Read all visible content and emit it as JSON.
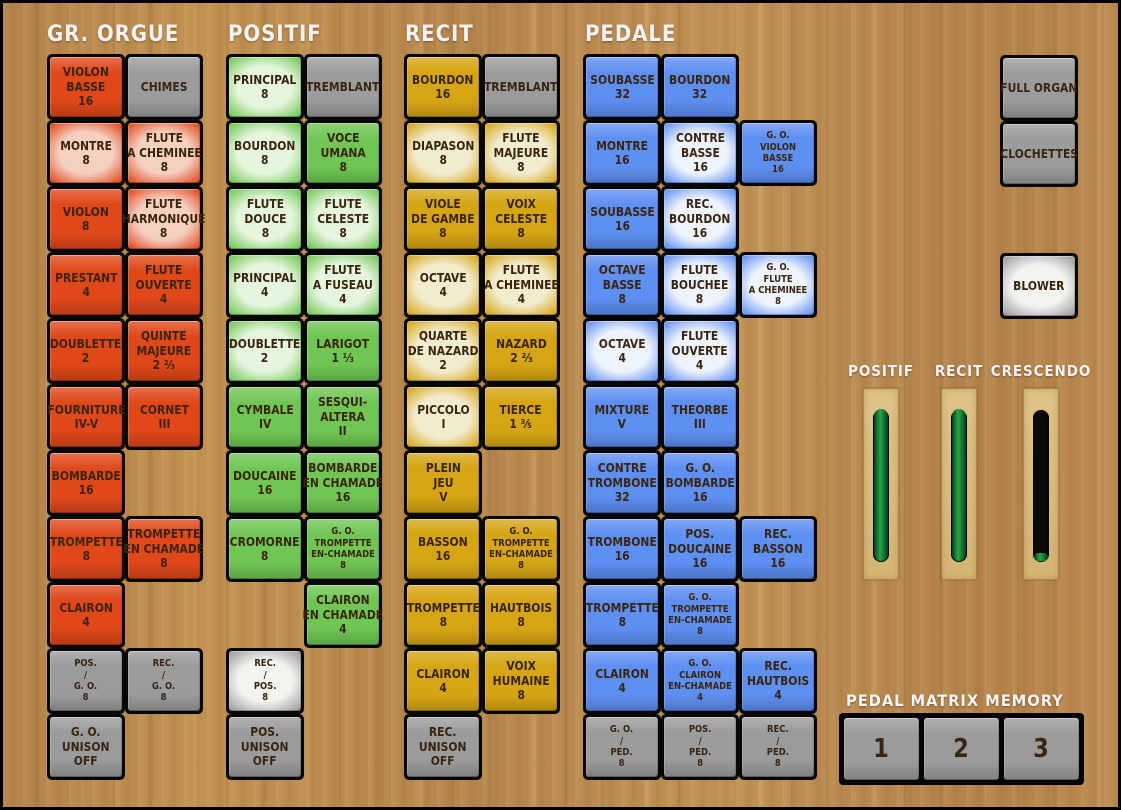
{
  "palette": {
    "gr_orgue": {
      "base": "#e0481a",
      "lit": "#f5cfc0"
    },
    "positif": {
      "base": "#70c653",
      "lit": "#e6f6de"
    },
    "recit": {
      "base": "#d5a513",
      "lit": "#f2ecce"
    },
    "pedale": {
      "base": "#5e8ff2",
      "lit": "#eef4fd"
    },
    "neutral": {
      "base": "#9b9b9b",
      "lit": "#f3f3f0"
    },
    "label_text": "#3a2510",
    "header_text": "#f3f3f3"
  },
  "divisions": [
    {
      "id": "gr-orgue",
      "label": "GR. ORGUE",
      "palette": "gr_orgue",
      "prefix": "stop",
      "origin": {
        "x": 47,
        "y": 54
      },
      "stops": [
        {
          "r": 1,
          "c": 1,
          "t": [
            "VIOLON",
            "BASSE",
            "16"
          ]
        },
        {
          "r": 1,
          "c": 2,
          "t": [
            "CHIMES"
          ],
          "kind": "neutral"
        },
        {
          "r": 2,
          "c": 1,
          "t": [
            "MONTRE",
            "8"
          ],
          "lit": true
        },
        {
          "r": 2,
          "c": 2,
          "t": [
            "FLUTE",
            "A CHEMINEE",
            "8"
          ],
          "lit": true
        },
        {
          "r": 3,
          "c": 1,
          "t": [
            "VIOLON",
            "8"
          ]
        },
        {
          "r": 3,
          "c": 2,
          "t": [
            "FLUTE",
            "HARMONIQUE",
            "8"
          ],
          "lit": true
        },
        {
          "r": 4,
          "c": 1,
          "t": [
            "PRESTANT",
            "4"
          ]
        },
        {
          "r": 4,
          "c": 2,
          "t": [
            "FLUTE",
            "OUVERTE",
            "4"
          ]
        },
        {
          "r": 5,
          "c": 1,
          "t": [
            "DOUBLETTE",
            "2"
          ]
        },
        {
          "r": 5,
          "c": 2,
          "t": [
            "QUINTE",
            "MAJEURE",
            "2 ⅔"
          ]
        },
        {
          "r": 6,
          "c": 1,
          "t": [
            "FOURNITURE",
            "IV-V"
          ]
        },
        {
          "r": 6,
          "c": 2,
          "t": [
            "CORNET",
            "III"
          ]
        },
        {
          "r": 7,
          "c": 1,
          "t": [
            "BOMBARDE",
            "16"
          ]
        },
        {
          "r": 8,
          "c": 1,
          "t": [
            "TROMPETTE",
            "8"
          ]
        },
        {
          "r": 8,
          "c": 2,
          "t": [
            "TROMPETTE",
            "EN CHAMADE",
            "8"
          ]
        },
        {
          "r": 9,
          "c": 1,
          "t": [
            "CLAIRON",
            "4"
          ]
        },
        {
          "r": 10,
          "c": 1,
          "t": [
            "POS.",
            "/",
            "G. O.",
            "8"
          ],
          "kind": "neutral",
          "small": true
        },
        {
          "r": 10,
          "c": 2,
          "t": [
            "REC.",
            "/",
            "G. O.",
            "8"
          ],
          "kind": "neutral",
          "small": true
        },
        {
          "r": 11,
          "c": 1,
          "t": [
            "G. O.",
            "UNISON",
            "OFF"
          ],
          "kind": "neutral"
        }
      ]
    },
    {
      "id": "positif",
      "label": "POSITIF",
      "palette": "positif",
      "prefix": "stop",
      "origin": {
        "x": 226,
        "y": 54
      },
      "stops": [
        {
          "r": 1,
          "c": 1,
          "t": [
            "PRINCIPAL",
            "8"
          ],
          "lit": true
        },
        {
          "r": 1,
          "c": 2,
          "t": [
            "TREMBLANT"
          ],
          "kind": "neutral"
        },
        {
          "r": 2,
          "c": 1,
          "t": [
            "BOURDON",
            "8"
          ],
          "lit": true
        },
        {
          "r": 2,
          "c": 2,
          "t": [
            "VOCE",
            "UMANA",
            "8"
          ]
        },
        {
          "r": 3,
          "c": 1,
          "t": [
            "FLUTE",
            "DOUCE",
            "8"
          ],
          "lit": true
        },
        {
          "r": 3,
          "c": 2,
          "t": [
            "FLUTE",
            "CELESTE",
            "8"
          ],
          "lit": true
        },
        {
          "r": 4,
          "c": 1,
          "t": [
            "PRINCIPAL",
            "4"
          ],
          "lit": true
        },
        {
          "r": 4,
          "c": 2,
          "t": [
            "FLUTE",
            "A FUSEAU",
            "4"
          ],
          "lit": true
        },
        {
          "r": 5,
          "c": 1,
          "t": [
            "DOUBLETTE",
            "2"
          ],
          "lit": true
        },
        {
          "r": 5,
          "c": 2,
          "t": [
            "LARIGOT",
            "1 ⅓"
          ]
        },
        {
          "r": 6,
          "c": 1,
          "t": [
            "CYMBALE",
            "IV"
          ]
        },
        {
          "r": 6,
          "c": 2,
          "t": [
            "SESQUI-",
            "ALTERA",
            "II"
          ]
        },
        {
          "r": 7,
          "c": 1,
          "t": [
            "DOUCAINE",
            "16"
          ]
        },
        {
          "r": 7,
          "c": 2,
          "t": [
            "BOMBARDE",
            "EN CHAMADE",
            "16"
          ]
        },
        {
          "r": 8,
          "c": 1,
          "t": [
            "CROMORNE",
            "8"
          ]
        },
        {
          "r": 8,
          "c": 2,
          "t": [
            "G. O.",
            "TROMPETTE",
            "EN-CHAMADE",
            "8"
          ],
          "small": true
        },
        {
          "r": 9,
          "c": 2,
          "t": [
            "CLAIRON",
            "EN CHAMADE",
            "4"
          ]
        },
        {
          "r": 10,
          "c": 1,
          "t": [
            "REC.",
            "/",
            "POS.",
            "8"
          ],
          "kind": "neutral",
          "small": true,
          "lit": true
        },
        {
          "r": 11,
          "c": 1,
          "t": [
            "POS.",
            "UNISON",
            "OFF"
          ],
          "kind": "neutral"
        }
      ]
    },
    {
      "id": "recit",
      "label": "RECIT",
      "palette": "recit",
      "prefix": "stop",
      "origin": {
        "x": 404,
        "y": 54
      },
      "stops": [
        {
          "r": 1,
          "c": 1,
          "t": [
            "BOURDON",
            "16"
          ]
        },
        {
          "r": 1,
          "c": 2,
          "t": [
            "TREMBLANT"
          ],
          "kind": "neutral"
        },
        {
          "r": 2,
          "c": 1,
          "t": [
            "DIAPASON",
            "8"
          ],
          "lit": true
        },
        {
          "r": 2,
          "c": 2,
          "t": [
            "FLUTE",
            "MAJEURE",
            "8"
          ],
          "lit": true
        },
        {
          "r": 3,
          "c": 1,
          "t": [
            "VIOLE",
            "DE GAMBE",
            "8"
          ]
        },
        {
          "r": 3,
          "c": 2,
          "t": [
            "VOIX",
            "CELESTE",
            "8"
          ]
        },
        {
          "r": 4,
          "c": 1,
          "t": [
            "OCTAVE",
            "4"
          ],
          "lit": true
        },
        {
          "r": 4,
          "c": 2,
          "t": [
            "FLUTE",
            "A CHEMINEE",
            "4"
          ],
          "lit": true
        },
        {
          "r": 5,
          "c": 1,
          "t": [
            "QUARTE",
            "DE NAZARD",
            "2"
          ],
          "lit": true
        },
        {
          "r": 5,
          "c": 2,
          "t": [
            "NAZARD",
            "2 ⅔"
          ]
        },
        {
          "r": 6,
          "c": 1,
          "t": [
            "PICCOLO",
            "I"
          ],
          "lit": true
        },
        {
          "r": 6,
          "c": 2,
          "t": [
            "TIERCE",
            "1 ⅗"
          ]
        },
        {
          "r": 7,
          "c": 1,
          "t": [
            "PLEIN",
            "JEU",
            "V"
          ]
        },
        {
          "r": 8,
          "c": 1,
          "t": [
            "BASSON",
            "16"
          ]
        },
        {
          "r": 8,
          "c": 2,
          "t": [
            "G. O.",
            "TROMPETTE",
            "EN-CHAMADE",
            "8"
          ],
          "small": true
        },
        {
          "r": 9,
          "c": 1,
          "t": [
            "TROMPETTE",
            "8"
          ]
        },
        {
          "r": 9,
          "c": 2,
          "t": [
            "HAUTBOIS",
            "8"
          ]
        },
        {
          "r": 10,
          "c": 1,
          "t": [
            "CLAIRON",
            "4"
          ]
        },
        {
          "r": 10,
          "c": 2,
          "t": [
            "VOIX",
            "HUMAINE",
            "8"
          ]
        },
        {
          "r": 11,
          "c": 1,
          "t": [
            "REC.",
            "UNISON",
            "OFF"
          ],
          "kind": "neutral"
        }
      ]
    },
    {
      "id": "pedale",
      "label": "PEDALE",
      "palette": "pedale",
      "prefix": "stop",
      "origin": {
        "x": 583,
        "y": 54
      },
      "stops": [
        {
          "r": 1,
          "c": 1,
          "t": [
            "SOUBASSE",
            "32"
          ]
        },
        {
          "r": 1,
          "c": 2,
          "t": [
            "BOURDON",
            "32"
          ]
        },
        {
          "r": 2,
          "c": 1,
          "t": [
            "MONTRE",
            "16"
          ]
        },
        {
          "r": 2,
          "c": 2,
          "t": [
            "CONTRE",
            "BASSE",
            "16"
          ],
          "lit": true
        },
        {
          "r": 2,
          "c": 3,
          "t": [
            "G. O.",
            "VIOLON",
            "BASSE",
            "16"
          ],
          "small": true
        },
        {
          "r": 3,
          "c": 1,
          "t": [
            "SOUBASSE",
            "16"
          ]
        },
        {
          "r": 3,
          "c": 2,
          "t": [
            "REC.",
            "BOURDON",
            "16"
          ],
          "lit": true
        },
        {
          "r": 4,
          "c": 1,
          "t": [
            "OCTAVE",
            "BASSE",
            "8"
          ]
        },
        {
          "r": 4,
          "c": 2,
          "t": [
            "FLUTE",
            "BOUCHEE",
            "8"
          ],
          "lit": true
        },
        {
          "r": 4,
          "c": 3,
          "t": [
            "G. O.",
            "FLUTE",
            "A CHEMINEE",
            "8"
          ],
          "small": true,
          "lit": true
        },
        {
          "r": 5,
          "c": 1,
          "t": [
            "OCTAVE",
            "4"
          ],
          "lit": true
        },
        {
          "r": 5,
          "c": 2,
          "t": [
            "FLUTE",
            "OUVERTE",
            "4"
          ],
          "lit": true
        },
        {
          "r": 6,
          "c": 1,
          "t": [
            "MIXTURE",
            "V"
          ]
        },
        {
          "r": 6,
          "c": 2,
          "t": [
            "THEORBE",
            "III"
          ]
        },
        {
          "r": 7,
          "c": 1,
          "t": [
            "CONTRE",
            "TROMBONE",
            "32"
          ]
        },
        {
          "r": 7,
          "c": 2,
          "t": [
            "G. O.",
            "BOMBARDE",
            "16"
          ]
        },
        {
          "r": 8,
          "c": 1,
          "t": [
            "TROMBONE",
            "16"
          ]
        },
        {
          "r": 8,
          "c": 2,
          "t": [
            "POS.",
            "DOUCAINE",
            "16"
          ]
        },
        {
          "r": 8,
          "c": 3,
          "t": [
            "REC.",
            "BASSON",
            "16"
          ]
        },
        {
          "r": 9,
          "c": 1,
          "t": [
            "TROMPETTE",
            "8"
          ]
        },
        {
          "r": 9,
          "c": 2,
          "t": [
            "G. O.",
            "TROMPETTE",
            "EN-CHAMADE",
            "8"
          ],
          "small": true
        },
        {
          "r": 10,
          "c": 1,
          "t": [
            "CLAIRON",
            "4"
          ]
        },
        {
          "r": 10,
          "c": 2,
          "t": [
            "G. O.",
            "CLAIRON",
            "EN-CHAMADE",
            "4"
          ],
          "small": true
        },
        {
          "r": 10,
          "c": 3,
          "t": [
            "REC.",
            "HAUTBOIS",
            "4"
          ]
        },
        {
          "r": 11,
          "c": 1,
          "t": [
            "G. O.",
            "/",
            "PED.",
            "8"
          ],
          "kind": "neutral",
          "small": true
        },
        {
          "r": 11,
          "c": 2,
          "t": [
            "POS.",
            "/",
            "PED.",
            "8"
          ],
          "kind": "neutral",
          "small": true
        },
        {
          "r": 11,
          "c": 3,
          "t": [
            "REC.",
            "/",
            "PED.",
            "8"
          ],
          "kind": "neutral",
          "small": true
        }
      ]
    },
    {
      "id": "controls",
      "label": "",
      "palette": "neutral",
      "prefix": "button",
      "origin": {
        "x": 1000,
        "y": 55
      },
      "stops": [
        {
          "r": 1,
          "c": 1,
          "t": [
            "FULL ORGAN"
          ],
          "kind": "neutral"
        },
        {
          "r": 2,
          "c": 1,
          "t": [
            "CLOCHETTES"
          ],
          "kind": "neutral"
        },
        {
          "r": 4,
          "c": 1,
          "t": [
            "BLOWER"
          ],
          "kind": "neutral",
          "lit": true
        }
      ]
    }
  ],
  "sliders": {
    "y": 388,
    "items": [
      {
        "label": "POSITIF",
        "x": 863,
        "label_cx": 881,
        "value_pct": 100
      },
      {
        "label": "RECIT",
        "x": 941,
        "label_cx": 959,
        "value_pct": 100
      },
      {
        "label": "CRESCENDO",
        "x": 1023,
        "label_cx": 1041,
        "value_pct": 5
      }
    ]
  },
  "memory": {
    "title": "PEDAL MATRIX MEMORY",
    "buttons": [
      "1",
      "2",
      "3"
    ]
  }
}
